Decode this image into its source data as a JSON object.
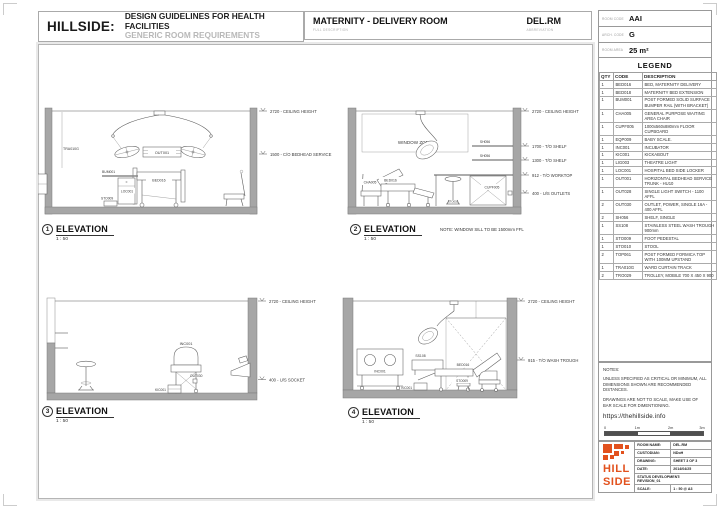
{
  "header": {
    "brand": "HILLSIDE:",
    "title": "DESIGN GUIDELINES FOR HEALTH FACILITIES",
    "subtitle": "GENERIC ROOM REQUIREMENTS",
    "room": {
      "full": "MATERNITY - DELIVERY ROOM",
      "full_caption": "FULL DESCRIPTION",
      "abbr": "DEL.RM",
      "abbr_caption": "ABBREVIATION"
    },
    "codes": [
      {
        "label": "ROOM CODE",
        "value": "AAI"
      },
      {
        "label": "ARCH. CODE",
        "value": "G"
      },
      {
        "label": "ROOM AREA",
        "value": "25 m²"
      }
    ]
  },
  "legend": {
    "title": "LEGEND",
    "columns": {
      "qty": "QTY",
      "code": "CODE",
      "desc": "DESCRIPTION"
    },
    "rows": [
      {
        "qty": "1",
        "code": "BED016",
        "desc": "BED, MATERNITY DELIVERY"
      },
      {
        "qty": "1",
        "code": "BED018",
        "desc": "MATERNITY BED EXTENSION"
      },
      {
        "qty": "1",
        "code": "BUM001",
        "desc": "POST FORMED SOLID SURFACE BUMPER RAIL (WITH BRACKET)"
      },
      {
        "qty": "1",
        "code": "CHA005",
        "desc": "GENERAL PURPOSE WAITING AREA CHAIR"
      },
      {
        "qty": "1",
        "code": "CUPF005",
        "desc": "1000x560x880mm FLOOR CUPBOARD"
      },
      {
        "qty": "1",
        "code": "EQP009",
        "desc": "BABY SCALE."
      },
      {
        "qty": "1",
        "code": "INC001",
        "desc": "INCUBATOR"
      },
      {
        "qty": "1",
        "code": "KIC001",
        "desc": "KICKABOUT"
      },
      {
        "qty": "1",
        "code": "LIG003",
        "desc": "THEATRE LIGHT"
      },
      {
        "qty": "1",
        "code": "LOC001",
        "desc": "HOSPITAL BED SIDE LOCKER"
      },
      {
        "qty": "1",
        "code": "OUT001",
        "desc": "HORIZONTAL BEDHEAD SERVICE TRUNK - HU10"
      },
      {
        "qty": "1",
        "code": "OUT028",
        "desc": "SINGLE LIGHT SWITCH - 1100 AFFL"
      },
      {
        "qty": "2",
        "code": "OUT030",
        "desc": "OUTLET, POWER, SINGLE 16A - 400 AFFL"
      },
      {
        "qty": "2",
        "code": "SH056",
        "desc": "SHELF, SINGLE"
      },
      {
        "qty": "1",
        "code": "SS108",
        "desc": "STAINLESS STEEL WASH TROUGH 900mm"
      },
      {
        "qty": "1",
        "code": "STO009",
        "desc": "FOOT PEDESTAL"
      },
      {
        "qty": "1",
        "code": "STO010",
        "desc": "STOOL"
      },
      {
        "qty": "2",
        "code": "TOP061",
        "desc": "POST FORMED FORMICA TOP WITH 100MM UPSTAND"
      },
      {
        "qty": "1",
        "code": "TRA010G",
        "desc": "WARD CURTAIN TRACK"
      },
      {
        "qty": "2",
        "code": "TRO029",
        "desc": "TROLLEY, MOBILE 700 X 450 X 900"
      }
    ]
  },
  "notes": {
    "title": "NOTES:",
    "para1": "UNLESS SPECIFIED AS CRITICAL OR MINIMUM, ALL DIMENSIONS SHOWN ARE RECOMMENDED DISTANCES.",
    "para2": "DRAWINGS ARE NOT TO SCALE, MAKE USE OF BAR SCALE FOR DIMENTIONING.",
    "url": "https://thehillside.info",
    "scale_ticks": {
      "t0": "0",
      "t1": "1m",
      "t2": "2m",
      "t3": "3m"
    }
  },
  "titleblock": {
    "logo_line1": "HILL",
    "logo_line2": "SIDE",
    "rows": [
      {
        "label": "ROOM NAME:",
        "value": "DEL.RM"
      },
      {
        "label": "CUSTODIAN:",
        "value": "NDoH"
      },
      {
        "label": "DRAWING:",
        "value": "SHEET 3 OF 3"
      },
      {
        "label": "DATE:",
        "value": "2014/04/25"
      },
      {
        "label": "STATUS DEVELOPMENT:",
        "value": "REVISION_01"
      },
      {
        "label": "SCALE:",
        "value": "1 : 50 @ A3"
      }
    ]
  },
  "elevations": {
    "e1": {
      "number": "1",
      "title": "ELEVATION",
      "scale": "1 : 50",
      "labels": {
        "tra": "TRA010G",
        "bum": "BUM001",
        "loc": "LOC001",
        "sto": "STO009",
        "bed": "BED016",
        "out": "OUT001"
      },
      "dims": {
        "ceiling": "2720 - CEILING HEIGHT",
        "bedhead": "1500 - C/O BEDHEAD SERVICE"
      }
    },
    "e2": {
      "number": "2",
      "title": "ELEVATION",
      "scale": "1 : 50",
      "labels": {
        "window": "WINDOW ZONE",
        "cha": "CHA005",
        "bed": "BED016",
        "sto": "STO010",
        "sh1": "SH056",
        "sh2": "SH056",
        "cupf": "CUPF005"
      },
      "dims": {
        "ceiling": "2720 - CEILING HEIGHT",
        "shelf1": "1700 - T/O SHELF",
        "shelf2": "1300 - T/O SHELF",
        "worktop": "912 - T/O WORKTOP",
        "outlets": "400 - U/S OUTLETS"
      },
      "note": "NOTE: WINDOW SILL TO BE 1500mm FFL"
    },
    "e3": {
      "number": "3",
      "title": "ELEVATION",
      "scale": "1 : 50",
      "labels": {
        "inc": "INC001",
        "kic": "KIC001",
        "out": "OUT030"
      },
      "dims": {
        "ceiling": "2720 - CEILING HEIGHT",
        "socket": "400 - U/S SOCKET"
      }
    },
    "e4": {
      "number": "4",
      "title": "ELEVATION",
      "scale": "1 : 50",
      "labels": {
        "inc": "INC001",
        "ss": "SS108",
        "bed": "BED016",
        "sto": "STO009",
        "kic": "KIC001"
      },
      "dims": {
        "ceiling": "2720 - CEILING HEIGHT",
        "trough": "915 - T/O WASH TROUGH"
      }
    }
  },
  "colors": {
    "accent_orange": "#E2511D",
    "wall_gray": "#A6A6A6"
  }
}
